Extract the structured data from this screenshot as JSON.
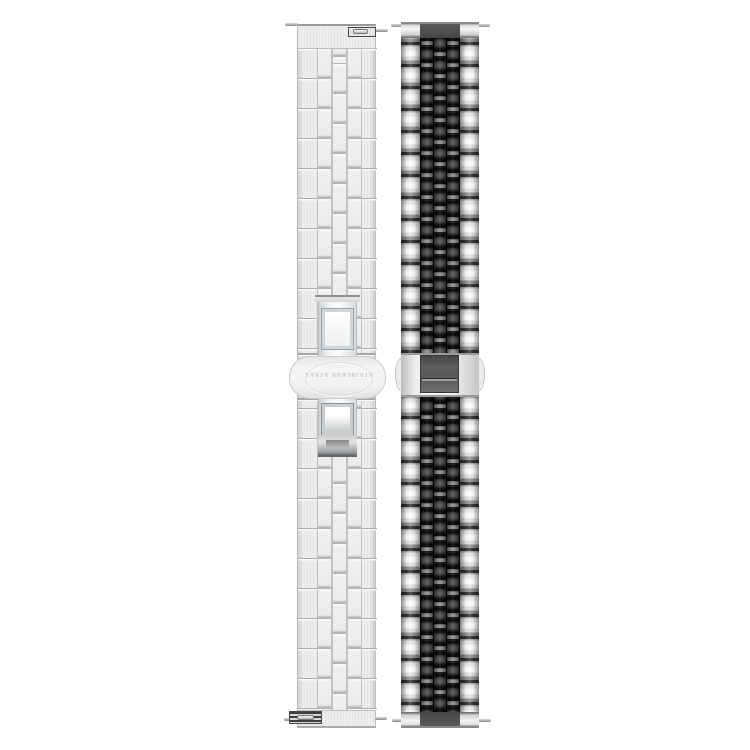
{
  "scene": {
    "type": "product-photo",
    "background_color": "#ffffff",
    "description": "Two stainless steel watch straps photographed vertically side by side on white",
    "clasp_engraving": "STAINLESS STEEL"
  },
  "left_band": {
    "label": "brushed silver five-piece link band with butterfly deployant clasp",
    "finish": "brushed silver",
    "clasp_engraving": "STAINLESS STEEL",
    "engraving_rotation_deg": 180,
    "quick_release_tabs": 2,
    "spring_bar_pins": 4,
    "colors": {
      "base": "#ededed",
      "link_outline": "#c0c0c0",
      "seam": "#aeaeae",
      "clasp_highlight": "#fbfcfd",
      "clasp_shadow": "#6f7375"
    }
  },
  "right_band": {
    "label": "jubilee-style band with polished silver outer links and black center links",
    "finish": "two-tone silver and black",
    "spring_bar_pins": 4,
    "colors": {
      "silver_bright": "#fdfdfd",
      "silver_seam": "#333333",
      "link_black": "#0c0c0c",
      "link_black_mid": "#565656",
      "clasp_plate_gray": "#5f5f5f"
    }
  }
}
